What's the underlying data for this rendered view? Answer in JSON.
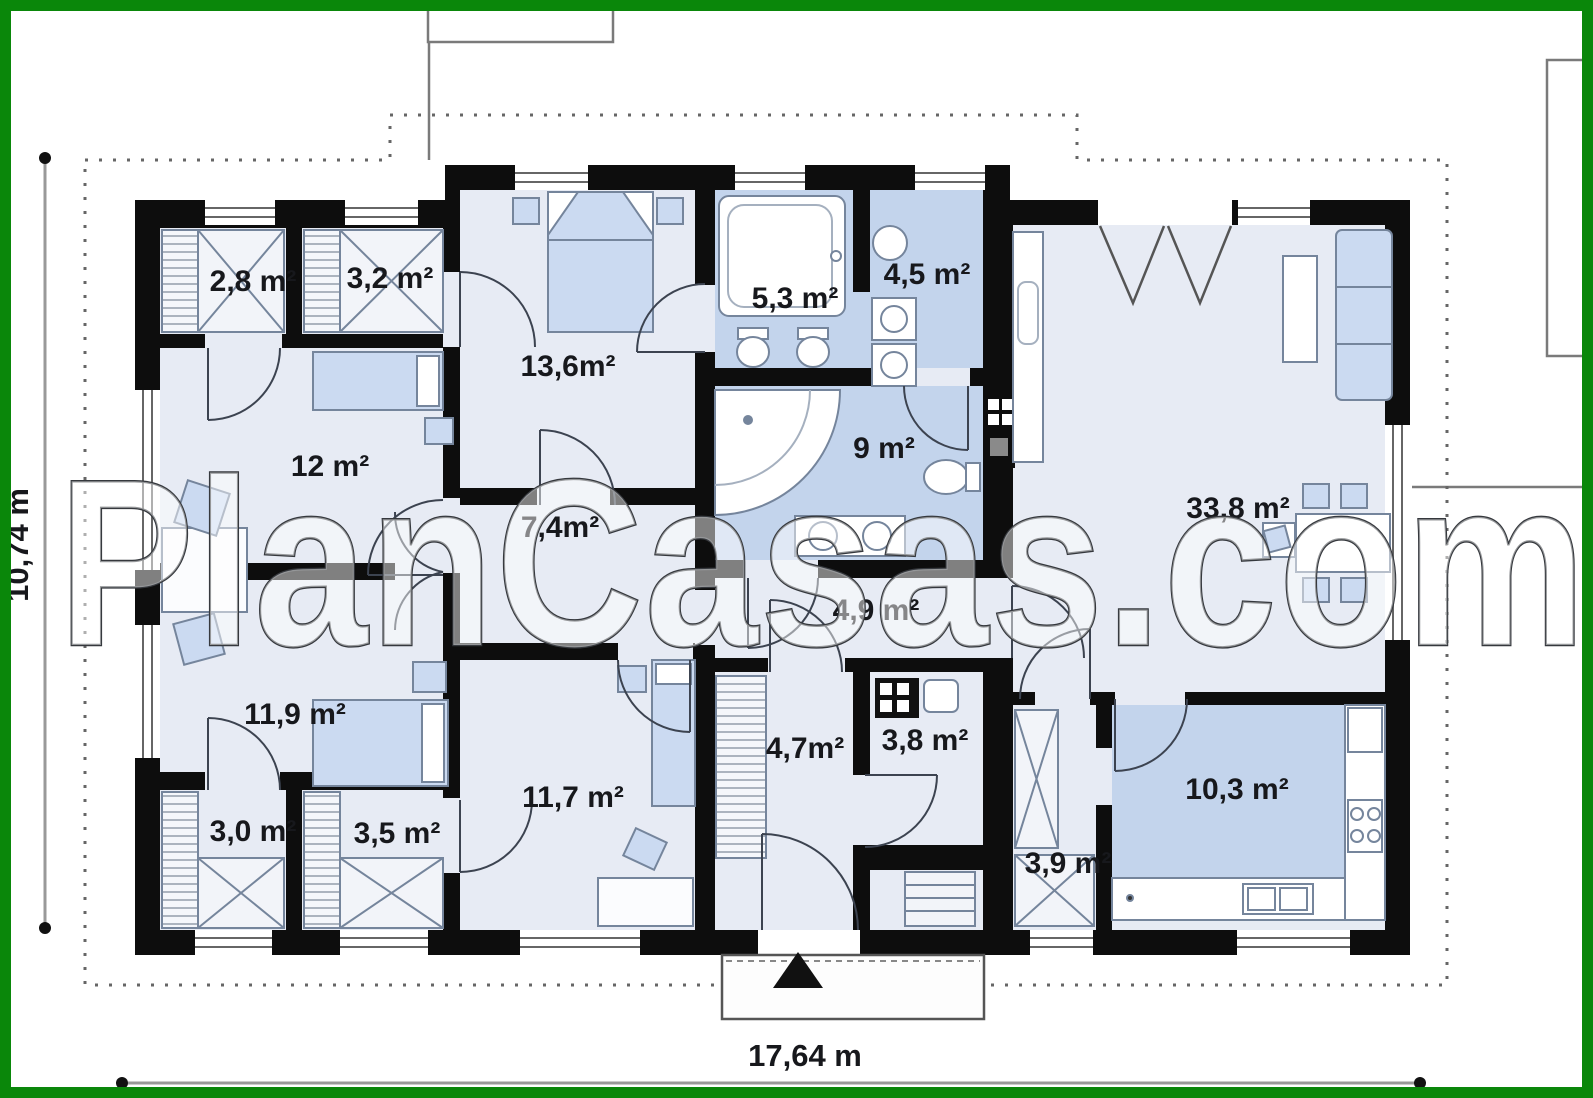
{
  "watermark": "PlanCasas.com",
  "dimensions": {
    "horizontal_label": "17,64 m",
    "vertical_label": "10,74 m"
  },
  "rooms": [
    {
      "id": "closet-1",
      "label": "2,8 m²"
    },
    {
      "id": "closet-2",
      "label": "3,2 m²"
    },
    {
      "id": "bedroom-top",
      "label": "13,6m²"
    },
    {
      "id": "bathroom-main",
      "label": "5,3 m²"
    },
    {
      "id": "laundry",
      "label": "4,5 m²"
    },
    {
      "id": "study",
      "label": "12 m²"
    },
    {
      "id": "hall",
      "label": "7,4m²"
    },
    {
      "id": "bathroom-2",
      "label": "9 m²"
    },
    {
      "id": "living-room",
      "label": "33,8 m²"
    },
    {
      "id": "corridor",
      "label": "4,9 m²"
    },
    {
      "id": "bedroom-left",
      "label": "11,9 m²"
    },
    {
      "id": "bedroom-bottom",
      "label": "11,7 m²"
    },
    {
      "id": "entry-hall",
      "label": "4,7m²"
    },
    {
      "id": "wc",
      "label": "3,8 m²"
    },
    {
      "id": "closet-3",
      "label": "3,0 m²"
    },
    {
      "id": "closet-4",
      "label": "3,5 m²"
    },
    {
      "id": "pantry",
      "label": "3,9 m²"
    },
    {
      "id": "kitchen",
      "label": "10,3 m²"
    }
  ],
  "colors": {
    "frame_green": "#0a870a",
    "wall_black": "#0d0d0d",
    "floor_light": "#e7ebf4",
    "floor_wet_blue": "#c3d4ec",
    "furniture_blue": "#cbdaf1",
    "dashed_boundary_gray": "#666666",
    "dimension_gray": "#999999"
  }
}
